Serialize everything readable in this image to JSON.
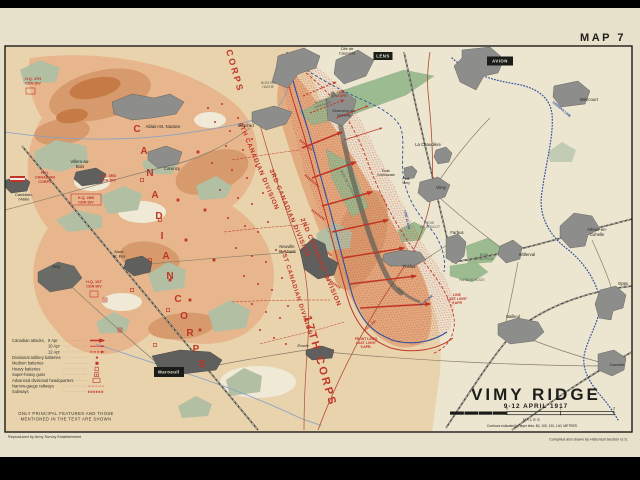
{
  "frame": {
    "map_number": "MAP 7"
  },
  "title_block": {
    "title": "VIMY RIDGE",
    "subtitle": "9-12 APRIL 1917",
    "scale_labels": [
      "0",
      "1",
      "2"
    ],
    "scale_tick_x": [
      507,
      560.5,
      614
    ],
    "scale_unit": "MILES",
    "contours_note": "Contours indicated by layer tints: 80, 100, 120, 140, METRES"
  },
  "credits": {
    "left": "Reproduced by Army Survey Establishment",
    "right": "Compiled and drawn by Historical Section G.S."
  },
  "legend": {
    "items": [
      {
        "label": "Canadian attacks,",
        "date": "9 Apr",
        "symbol": "arrow-solid"
      },
      {
        "label": "",
        "date": "10 Apr",
        "symbol": "arrow-line"
      },
      {
        "label": "",
        "date": "12 Apr",
        "symbol": "arrow-dashed"
      },
      {
        "label": "Divisional artillery batteries",
        "symbol": "dot"
      },
      {
        "label": "Medium batteries",
        "symbol": "square-filled"
      },
      {
        "label": "Heavy batteries",
        "symbol": "square-open"
      },
      {
        "label": "Super-heavy guns",
        "symbol": "super-heavy"
      },
      {
        "label": "Advanced divisional headquarters",
        "symbol": "hq-box"
      },
      {
        "label": "Narrow-gauge railways",
        "symbol": "railway"
      },
      {
        "label": "Subways",
        "symbol": "subway"
      }
    ],
    "note_line1": "ONLY PRINCIPAL FEATURES AND THOSE",
    "note_line2": "MENTIONED IN THE TEXT ARE SHOWN"
  },
  "colors": {
    "red": "#c03526",
    "blue": "#2f4f9e",
    "black": "#1d1d1b",
    "wood_green": "#9dbb90",
    "wood_label": "#51604c",
    "urban_gray": "#8d8d8b",
    "page_cream": "#e7e0ca"
  },
  "map_labels": {
    "corps": [
      {
        "text": "1ST CORPS",
        "x": 228,
        "y": 58,
        "rotate": 74,
        "size": 9,
        "spacing": 2.5
      },
      {
        "text": "17TH CORPS",
        "x": 317,
        "y": 362,
        "rotate": 74,
        "size": 11,
        "spacing": 2.5
      }
    ],
    "corps_arc": [
      {
        "ch": "C",
        "x": 137,
        "y": 132
      },
      {
        "ch": "A",
        "x": 144,
        "y": 154
      },
      {
        "ch": "N",
        "x": 150,
        "y": 176
      },
      {
        "ch": "A",
        "x": 155,
        "y": 198
      },
      {
        "ch": "D",
        "x": 159,
        "y": 219
      },
      {
        "ch": "I",
        "x": 162,
        "y": 239
      },
      {
        "ch": "A",
        "x": 166,
        "y": 259
      },
      {
        "ch": "N",
        "x": 170,
        "y": 279
      },
      {
        "ch": "C",
        "x": 178,
        "y": 302
      },
      {
        "ch": "O",
        "x": 184,
        "y": 319
      },
      {
        "ch": "R",
        "x": 190,
        "y": 336
      },
      {
        "ch": "P",
        "x": 196,
        "y": 352
      },
      {
        "ch": "S",
        "x": 202,
        "y": 367
      }
    ],
    "divisions": [
      {
        "text": "4TH CANADIAN DIVISION",
        "x": 257,
        "y": 167,
        "rotate": 67
      },
      {
        "text": "3RD CANADIAN DIVISION",
        "x": 288,
        "y": 214,
        "rotate": 67
      },
      {
        "text": "2ND CANADIAN DIVISION",
        "x": 319,
        "y": 263,
        "rotate": 67
      },
      {
        "text": "1ST CANADIAN DIVISION",
        "x": 295,
        "y": 293,
        "rotate": 72,
        "size": 6
      }
    ],
    "headquarters": [
      {
        "text": "H.Q.\nCANADIAN\nCORPS",
        "x": 45,
        "y": 174,
        "flag": [
          10,
          176,
          15,
          6
        ]
      },
      {
        "text": "H.Q. 4TH\nCDN DIV",
        "x": 33,
        "y": 80,
        "box": [
          26,
          88,
          9,
          6
        ]
      },
      {
        "text": "H.Q. 3RD\nCDN DIV",
        "x": 108,
        "y": 177
      },
      {
        "text": "H.Q. 2ND\nCDN DIV",
        "x": 86,
        "y": 199,
        "box": [
          71,
          194,
          30,
          11
        ]
      },
      {
        "text": "H.Q. 1ST\nCDN DIV",
        "x": 94,
        "y": 283,
        "box": [
          90,
          291,
          8,
          6
        ]
      }
    ],
    "villages": [
      {
        "text": "Cité de\nCaumont",
        "x": 347,
        "y": 50,
        "size": 4
      },
      {
        "text": "Givenchy-en-\nGohelle",
        "x": 344,
        "y": 112,
        "size": 4
      },
      {
        "text": "La Chaudière",
        "x": 428,
        "y": 146
      },
      {
        "text": "École\nCommunale",
        "x": 386,
        "y": 172,
        "size": 3.3
      },
      {
        "text": "Petit\nVimy",
        "x": 406,
        "y": 180,
        "size": 3.5
      },
      {
        "text": "Vimy",
        "x": 441,
        "y": 189,
        "size": 4.6
      },
      {
        "text": "Méricourt",
        "x": 589,
        "y": 101
      },
      {
        "text": "Arleux-en-\nGohelle",
        "x": 597,
        "y": 231
      },
      {
        "text": "Willerval",
        "x": 527,
        "y": 256
      },
      {
        "text": "Oppy",
        "x": 623,
        "y": 285
      },
      {
        "text": "Bailleul",
        "x": 513,
        "y": 318
      },
      {
        "text": "Gavrelle",
        "x": 617,
        "y": 366,
        "size": 4
      },
      {
        "text": "Farbus",
        "x": 457,
        "y": 234
      },
      {
        "text": "Thélus",
        "x": 409,
        "y": 268
      },
      {
        "text": "Neuville\nSt. Vaast",
        "x": 287,
        "y": 248
      },
      {
        "text": "Écurie",
        "x": 303,
        "y": 347,
        "size": 4,
        "style": "italic"
      },
      {
        "text": "Ablain-St. Nazaire",
        "x": 163,
        "y": 128
      },
      {
        "text": "Souchez",
        "x": 246,
        "y": 127
      },
      {
        "text": "Carency",
        "x": 172,
        "y": 170
      },
      {
        "text": "Villers-au-\nBois",
        "x": 80,
        "y": 163
      },
      {
        "text": "Camblain-\nl'Abbé",
        "x": 24,
        "y": 196,
        "size": 4
      },
      {
        "text": "Mont\nSt. Eloi",
        "x": 119,
        "y": 253,
        "size": 4
      },
      {
        "text": "Acq",
        "x": 56,
        "y": 268
      }
    ],
    "city_boxes": [
      {
        "text": "LENS",
        "x": 383,
        "y": 56,
        "w": 19,
        "h": 8
      },
      {
        "text": "AVION",
        "x": 500,
        "y": 61,
        "w": 26,
        "h": 9
      },
      {
        "text": "Maroeuil",
        "x": 169,
        "y": 372,
        "w": 30,
        "h": 10
      }
    ],
    "woods": [
      {
        "text": "BOIS DE\nGIVENCHY",
        "x": 322,
        "y": 102,
        "rotate": -18
      },
      {
        "text": "BOIS EN\nHACHE",
        "x": 268,
        "y": 84
      },
      {
        "text": "BOIS DE LA FOLIE",
        "x": 347,
        "y": 184,
        "rotate": 62
      },
      {
        "text": "BOIS\nDU GOULOT",
        "x": 430,
        "y": 224
      },
      {
        "text": "BOIS\nDE LA VILLE",
        "x": 484,
        "y": 256
      },
      {
        "text": "FARBUS WOOD",
        "x": 472,
        "y": 281
      }
    ],
    "line_labels": [
      {
        "text": "FRONT LINES\nLAST LIGHT\n9 APR.",
        "x": 366,
        "y": 340,
        "color": "#c03526",
        "size": 3.4
      },
      {
        "text": "LINE\nLAST LIGHT\n9 APR",
        "x": 457,
        "y": 296,
        "color": "#c03526",
        "size": 3.4
      },
      {
        "text": "RED LINE",
        "x": 371,
        "y": 326,
        "color": "#c03526",
        "size": 3,
        "rotate": -42
      },
      {
        "text": "BLUE LINE",
        "x": 427,
        "y": 301,
        "color": "#2f4f9e",
        "size": 3,
        "rotate": -38
      },
      {
        "text": "LINE\n12 APR",
        "x": 341,
        "y": 93,
        "color": "#c03526",
        "size": 3.2
      },
      {
        "text": "LINE 12 APR",
        "x": 406,
        "y": 220,
        "color": "#2f4f9e",
        "size": 3.2,
        "rotate": 78
      },
      {
        "text": "GERMAN LINE",
        "x": 561,
        "y": 110,
        "color": "#2f4f9e",
        "size": 3.3,
        "rotate": 40
      }
    ]
  },
  "symbols": {
    "division_batteries": [
      [
        208,
        108
      ],
      [
        215,
        122
      ],
      [
        222,
        104
      ],
      [
        230,
        131
      ],
      [
        238,
        118
      ],
      [
        226,
        146
      ],
      [
        243,
        150
      ],
      [
        252,
        139
      ],
      [
        212,
        163
      ],
      [
        232,
        170
      ],
      [
        247,
        178
      ],
      [
        256,
        166
      ],
      [
        220,
        190
      ],
      [
        238,
        198
      ],
      [
        252,
        204
      ],
      [
        263,
        193
      ],
      [
        228,
        218
      ],
      [
        245,
        226
      ],
      [
        258,
        232
      ],
      [
        268,
        222
      ],
      [
        236,
        248
      ],
      [
        252,
        256
      ],
      [
        266,
        262
      ],
      [
        276,
        250
      ],
      [
        244,
        276
      ],
      [
        258,
        284
      ],
      [
        272,
        290
      ],
      [
        282,
        278
      ],
      [
        252,
        304
      ],
      [
        266,
        312
      ],
      [
        280,
        318
      ],
      [
        288,
        306
      ],
      [
        260,
        330
      ],
      [
        274,
        338
      ],
      [
        286,
        344
      ]
    ],
    "medium_batteries": [
      [
        198,
        152
      ],
      [
        205,
        210
      ],
      [
        214,
        260
      ],
      [
        190,
        300
      ],
      [
        200,
        330
      ],
      [
        186,
        240
      ],
      [
        178,
        200
      ],
      [
        170,
        280
      ]
    ],
    "heavy_batteries": [
      [
        160,
        220
      ],
      [
        168,
        310
      ],
      [
        150,
        260
      ],
      [
        142,
        180
      ],
      [
        155,
        345
      ],
      [
        132,
        290
      ]
    ],
    "super_heavy_guns": [
      [
        120,
        330
      ],
      [
        105,
        300
      ]
    ],
    "attacks_9apr": [
      [
        302,
        148,
        342,
        132
      ],
      [
        312,
        178,
        356,
        162
      ],
      [
        322,
        206,
        372,
        192
      ],
      [
        332,
        232,
        388,
        220
      ],
      [
        342,
        258,
        404,
        248
      ],
      [
        350,
        284,
        416,
        276
      ],
      [
        360,
        308,
        430,
        304
      ]
    ],
    "attacks_10apr": [
      [
        336,
        118,
        368,
        106
      ],
      [
        344,
        140,
        382,
        128
      ]
    ],
    "attacks_12apr": [
      [
        303,
        96,
        336,
        82
      ],
      [
        310,
        113,
        344,
        100
      ]
    ]
  }
}
